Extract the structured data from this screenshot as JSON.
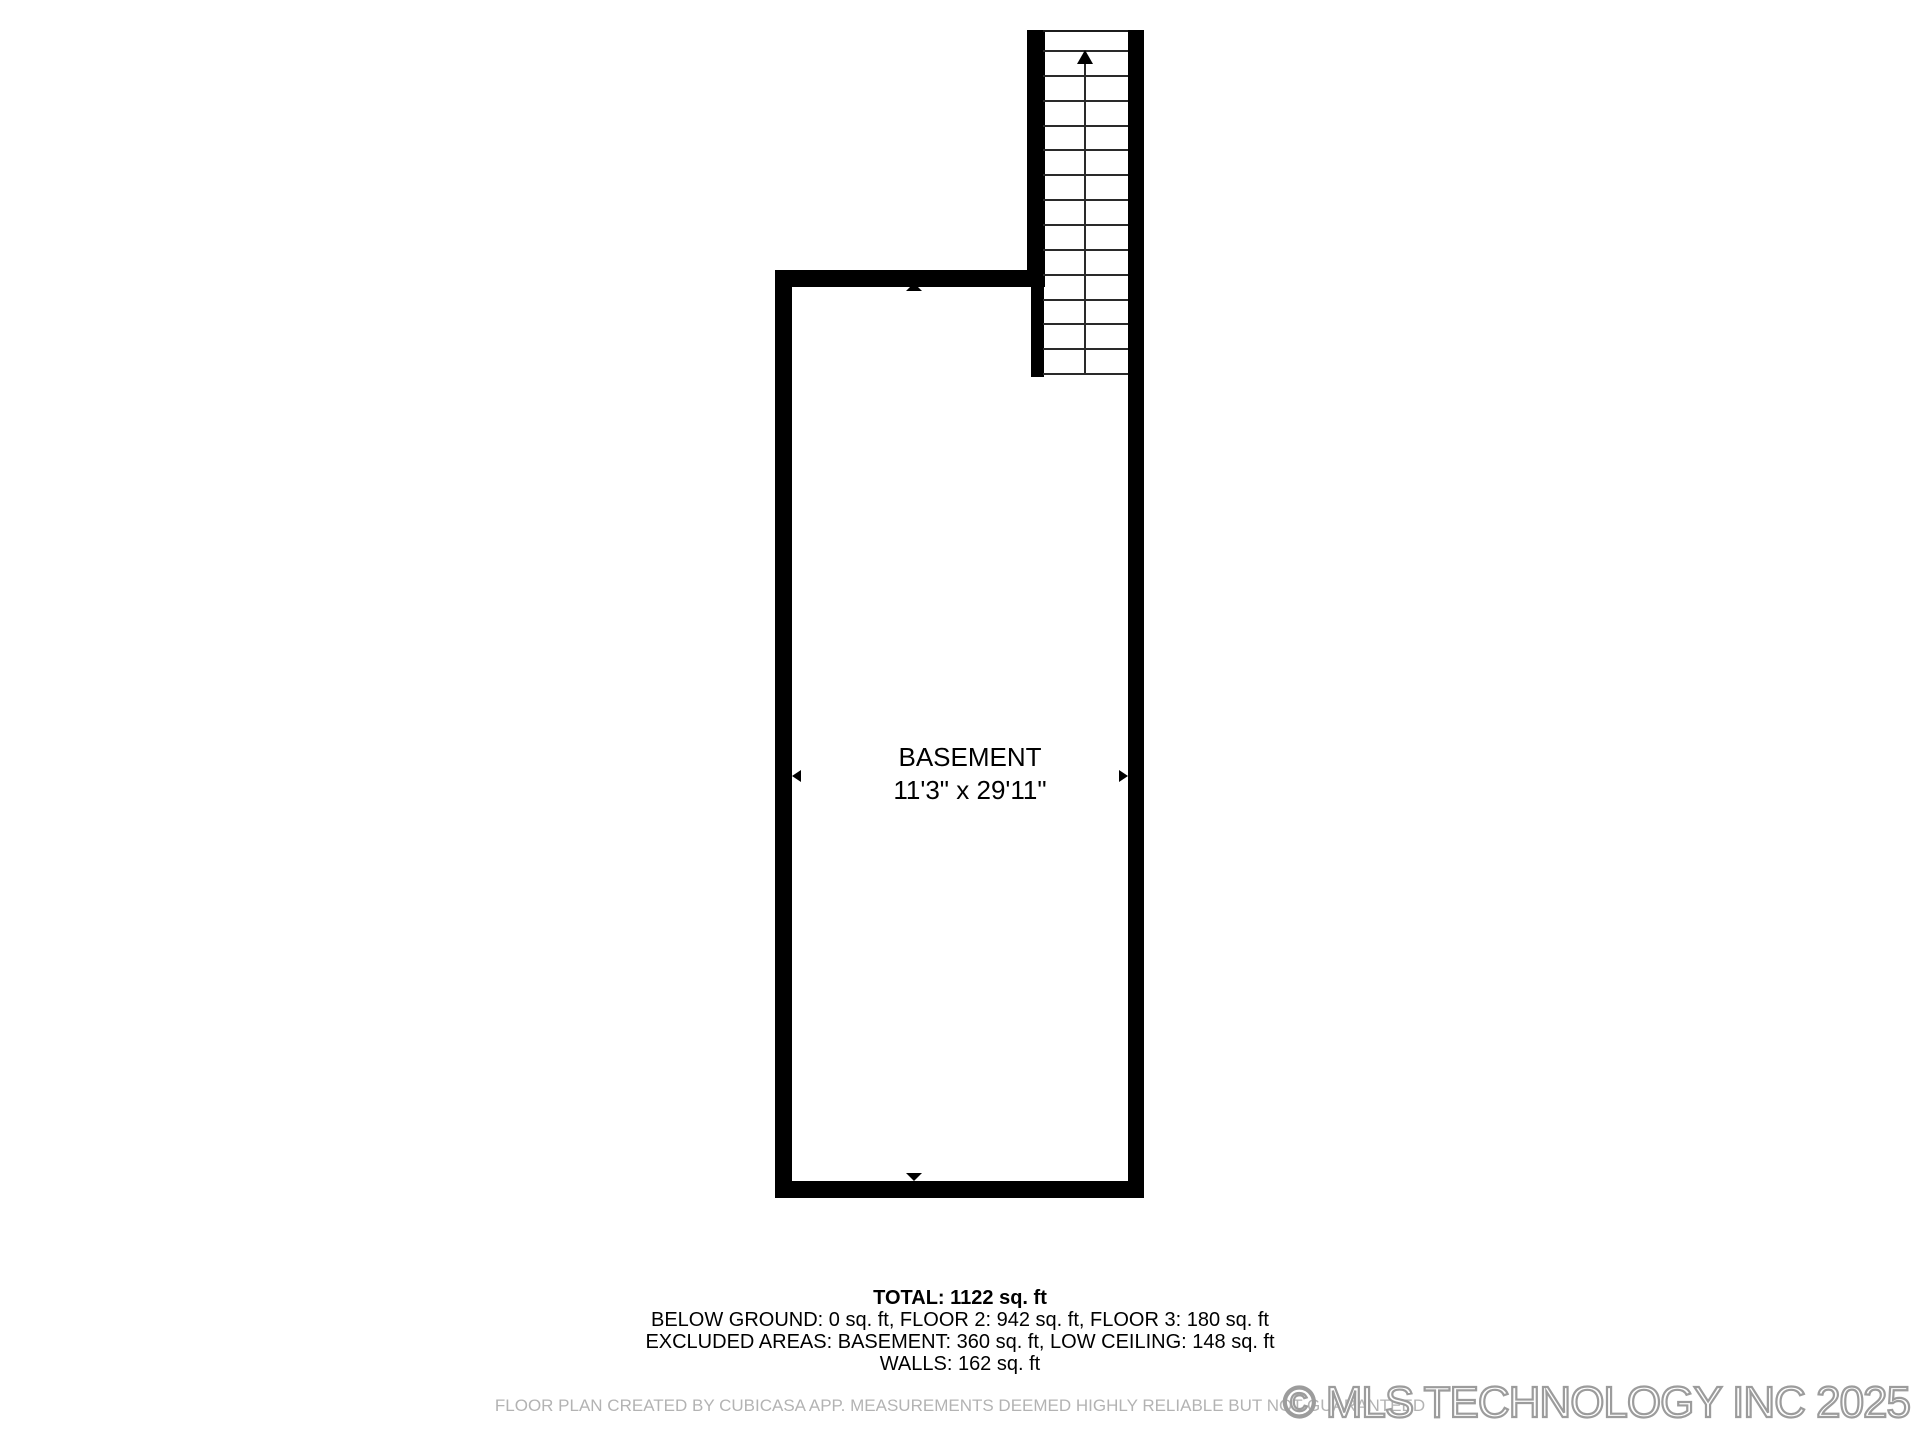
{
  "floor_plan": {
    "room": {
      "name": "BASEMENT",
      "dimensions": "11'3\" x 29'11\""
    },
    "stairs": {
      "direction": "up",
      "tread_lines": 14
    },
    "dimension_markers": [
      "up",
      "down",
      "left",
      "right"
    ]
  },
  "summary": {
    "total": "TOTAL: 1122 sq. ft",
    "lines": [
      "BELOW GROUND: 0 sq. ft, FLOOR 2: 942 sq. ft, FLOOR 3: 180 sq. ft",
      "EXCLUDED AREAS: BASEMENT: 360 sq. ft, LOW CEILING: 148 sq. ft",
      "WALLS: 162 sq. ft"
    ]
  },
  "footer": {
    "disclaimer": "FLOOR PLAN CREATED BY CUBICASA APP. MEASUREMENTS DEEMED HIGHLY RELIABLE BUT NOT GUARANTEED",
    "watermark": "© MLS TECHNOLOGY INC 2025"
  },
  "colors": {
    "background": "#ffffff",
    "walls": "#000000",
    "tread_lines": "#2a2a2a",
    "disclaimer_text": "#b3b3b3",
    "watermark_outline": "#9c9c9c"
  }
}
